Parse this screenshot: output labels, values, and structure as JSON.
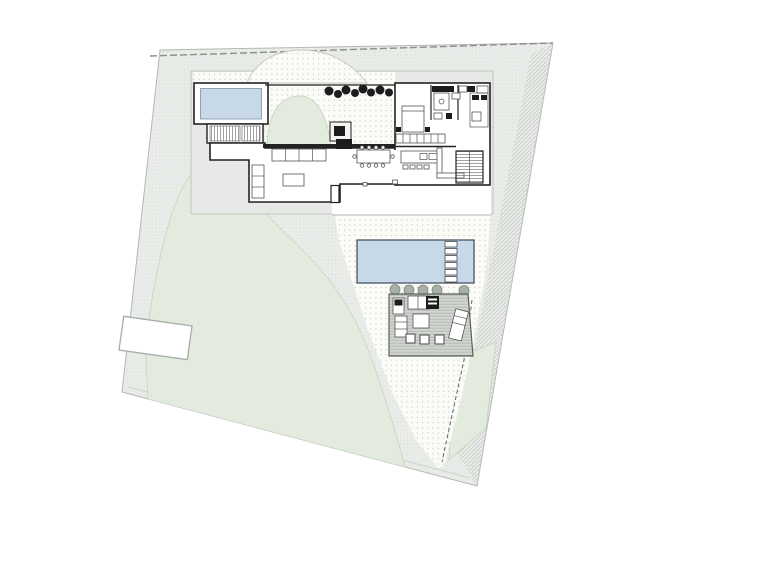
{
  "document": {
    "kind": "architectural-site-plan",
    "visible_text": []
  },
  "colors": {
    "page": "#ffffff",
    "site": "#e9ece8",
    "site-dot": "#cbd1cb",
    "boundary": "#b2b8b2",
    "dash": "#8a8f8a",
    "hill": "#e3ebde",
    "hill-edge": "#c6d4bf",
    "dotted-bg": "#fbfbf8",
    "dot": "#c6cbc2",
    "hatch-line": "#ccd1cc",
    "plateau": "#e6e9e5",
    "plateau-edge": "#b3b8b3",
    "wall": "#222222",
    "furn": "#555555",
    "pool": "#c7d9e9",
    "pool-edge": "#7d8fa3",
    "pool2-edge": "#3c4a57",
    "deck": "#d3d7d1",
    "deck-line": "#b5b9b3",
    "deck-edge": "#5a5f59",
    "bush": "#a8b1a6",
    "bush-edge": "#7e877c",
    "tree": "#1c1c1c",
    "white": "#ffffff"
  },
  "features": {
    "site_boundary": "irregular four-sided parcel, dashed top edge",
    "plunge_pool_top_left": {
      "color": "#c7d9e9"
    },
    "main_pool_center": {
      "color": "#c7d9e9",
      "ladder_steps": 6
    },
    "deck_bottom": {
      "lounge_chairs": 2,
      "stools": 3,
      "outdoor_kitchen": true
    },
    "tree_row_count": 8,
    "bush_row_count": 5,
    "green_mounds": 3,
    "parking_pad_left": true,
    "house_rooms": [
      "living-room",
      "dining-area",
      "kitchen-island",
      "bedroom",
      "bathrooms",
      "closet",
      "two-stairs",
      "courtyard-garden"
    ]
  }
}
